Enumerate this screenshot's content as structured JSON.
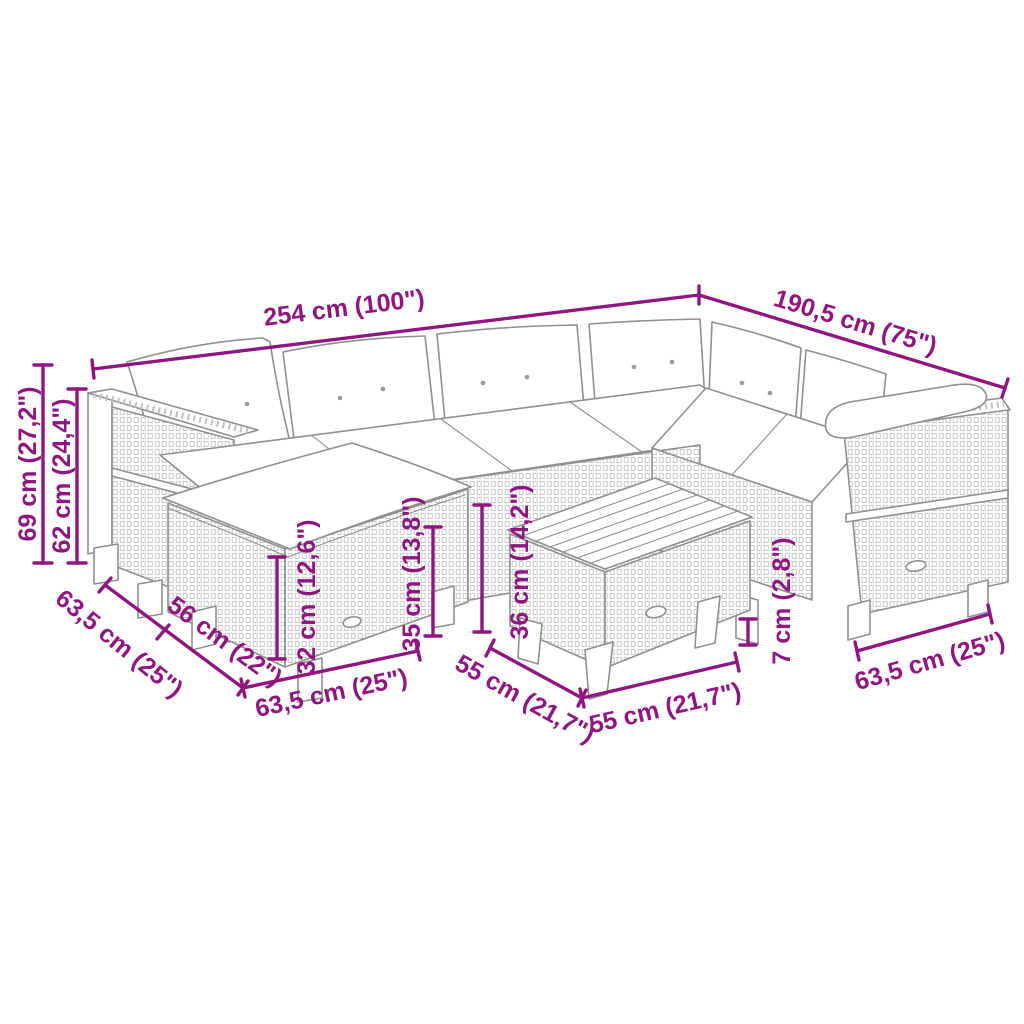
{
  "diagram": {
    "accent_color": "#8F1680",
    "line_color": "#8F8F8F"
  },
  "dims": {
    "total_length": "254 cm (100\")",
    "total_depth": "190,5 cm (75\")",
    "total_height": "69 cm (27,2\")",
    "back_height": "62 cm (24,4\")",
    "corner_depth": "63,5 cm (25\")",
    "ottoman_depth": "56 cm (22\")",
    "ottoman_width": "63,5 cm (25\")",
    "ottoman_height": "32 cm (12,6\")",
    "seat_height": "35 cm (13,8\")",
    "table_height": "36 cm (14,2\")",
    "table_width": "55 cm (21,7\")",
    "table_depth": "55 cm (21,7\")",
    "leg_height": "7 cm (2,8\")",
    "right_section_width": "63,5 cm (25\")"
  }
}
